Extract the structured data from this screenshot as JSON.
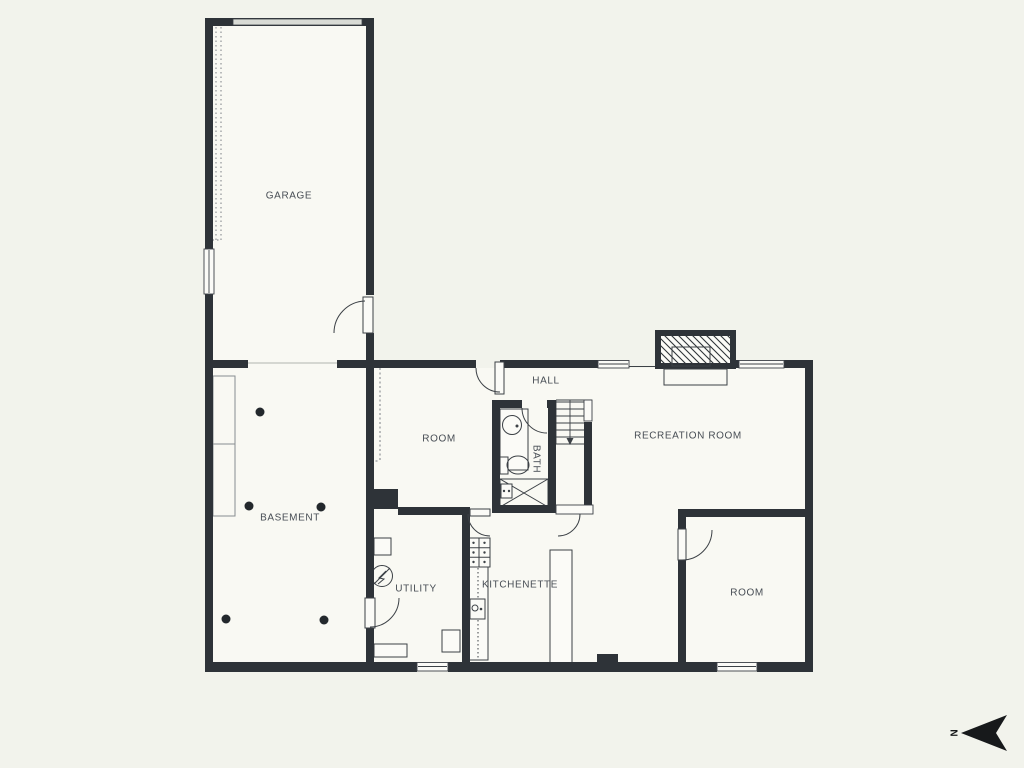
{
  "rooms": {
    "garage": {
      "label": "GARAGE"
    },
    "basement": {
      "label": "BASEMENT"
    },
    "hall": {
      "label": "HALL"
    },
    "middle_room": {
      "label": "ROOM"
    },
    "bath": {
      "label": "BATH"
    },
    "recreation_room": {
      "label": "RECREATION ROOM"
    },
    "lower_room": {
      "label": "ROOM"
    },
    "utility": {
      "label": "UTILITY"
    },
    "kitchenette": {
      "label": "KITCHENETTE"
    }
  },
  "compass": {
    "north_label": "N"
  },
  "colors": {
    "background": "#f2f3ec",
    "floor": "#f9f9f3",
    "wall": "#2e3338",
    "line": "#3c4146",
    "label_text": "#474d54",
    "garage_door": "#d9dbd5"
  }
}
